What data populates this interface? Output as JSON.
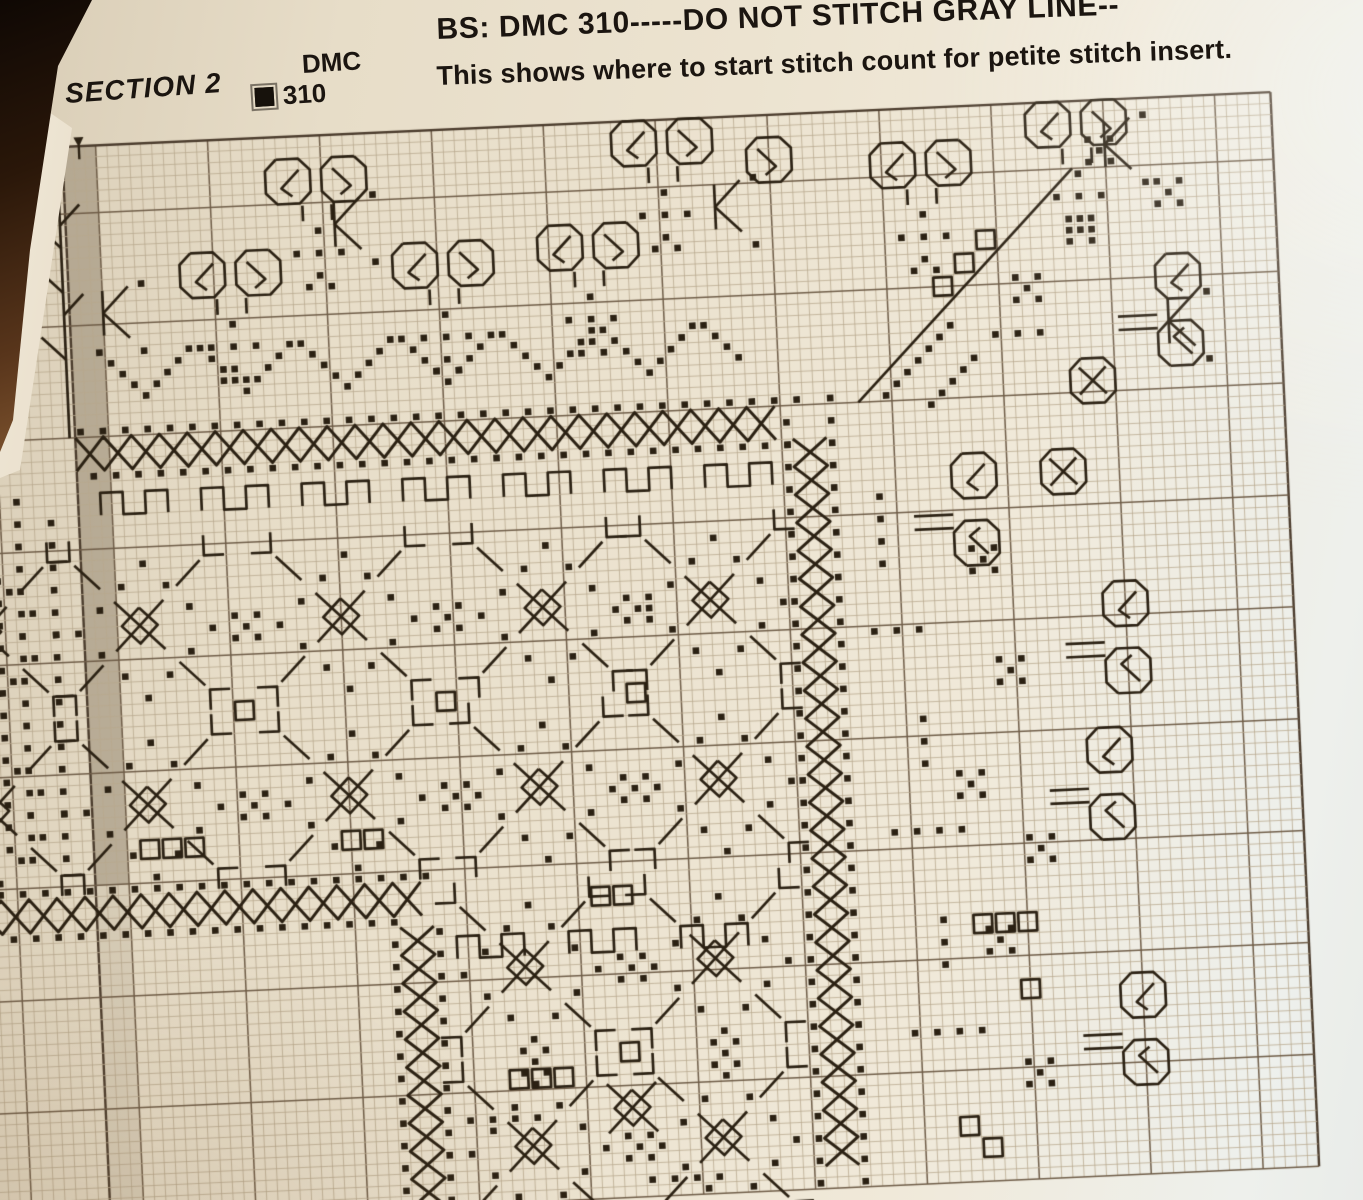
{
  "page": {
    "section_label": "SECTION 2",
    "legend": {
      "header": "DMC",
      "entries": [
        {
          "symbol": "filled-square",
          "code": "310"
        }
      ]
    },
    "note_line_1": "BS: DMC 310-----DO NOT STITCH GRAY LINE--",
    "note_line_2": "This shows where to start stitch count for petite stitch insert."
  },
  "colors": {
    "paper": "#ece3d0",
    "photo_background": "#20130b",
    "stitch": "#2b2113",
    "grid_line": "#b7a78d",
    "grid_bold": "#6e5c47",
    "grid_edge": "#4a3b2c",
    "gray_overlap_column": "#8d806a",
    "text": "#1b1510"
  },
  "chart_data": {
    "type": "cross-stitch-pattern-grid",
    "description": "Corner section of a blackwork-style cross stitch border chart in DMC 310; dotted/lattice frame bands, scroll lace edging, gray overlap column at left with start-arrow marker.",
    "grid": {
      "cell": 11.2,
      "col_min": -3,
      "col_max": 116,
      "row_max": 96,
      "left_edge_col": 8,
      "origin_x": 62,
      "origin_y": 147,
      "rotation_deg": -2.6,
      "bold_every": 10,
      "gray_column": {
        "col": 8,
        "width": 3,
        "row_fade": 66
      },
      "colors": {
        "line": "#b7a78d",
        "bold": "#6e5c47",
        "edge": "#4a3b2c",
        "stitch": "#2b2113",
        "gray": "#8d806a"
      }
    },
    "motifs": [
      {
        "t": "dotrun",
        "c": 8,
        "r": 25,
        "n": 33,
        "dx": 2,
        "dy": 0
      },
      {
        "t": "dotrun",
        "c": 9,
        "r": 29,
        "n": 32,
        "dx": 2,
        "dy": 0
      },
      {
        "t": "latticeH",
        "c": 8,
        "r": 26,
        "n": 64
      },
      {
        "t": "dotrun",
        "c": 71,
        "r": 27,
        "n": 35,
        "dx": 0,
        "dy": 2
      },
      {
        "t": "dotrun",
        "c": 75,
        "r": 25,
        "n": 36,
        "dx": 0,
        "dy": 2
      },
      {
        "t": "latticeV",
        "c": 72,
        "r": 29,
        "n": 66
      },
      {
        "t": "dotrun",
        "c": -3,
        "r": 66,
        "n": 21,
        "dx": 2,
        "dy": 0
      },
      {
        "t": "dotrun",
        "c": -2,
        "r": 70,
        "n": 19,
        "dx": 2,
        "dy": 0
      },
      {
        "t": "latticeH",
        "c": -3,
        "r": 67,
        "n": 41
      },
      {
        "t": "dotrun",
        "c": 34,
        "r": 72,
        "n": 12,
        "dx": 0,
        "dy": 2
      },
      {
        "t": "dotrun",
        "c": 38,
        "r": 71,
        "n": 13,
        "dx": 0,
        "dy": 2
      },
      {
        "t": "latticeV",
        "c": 35,
        "r": 71,
        "n": 25
      },
      {
        "t": "scrollpair",
        "c": 26,
        "r": 2
      },
      {
        "t": "scrollpair",
        "c": 57,
        "r": 0
      },
      {
        "t": "scroll",
        "c": 69,
        "r": 2,
        "fx": true
      },
      {
        "t": "scrollpair",
        "c": 94,
        "r": 0
      },
      {
        "t": "scrollpair",
        "c": 80,
        "r": 3
      },
      {
        "t": "scrollpair",
        "c": 18,
        "r": 10
      },
      {
        "t": "scrollpair",
        "c": 37,
        "r": 10
      },
      {
        "t": "scrollpair",
        "c": 50,
        "r": 9
      },
      {
        "t": "tree",
        "c": 30,
        "r": 8
      },
      {
        "t": "tree",
        "c": 61,
        "r": 6
      },
      {
        "t": "tree",
        "c": 22,
        "r": 16
      },
      {
        "t": "tree",
        "c": 41,
        "r": 16
      },
      {
        "t": "tree",
        "c": 54,
        "r": 15
      },
      {
        "t": "tree",
        "c": 84,
        "r": 9
      },
      {
        "t": "tree",
        "c": 98,
        "r": 6
      },
      {
        "t": "arrow",
        "c": 32,
        "r": 6
      },
      {
        "t": "arrow",
        "c": 66,
        "r": 6
      },
      {
        "t": "arrow",
        "c": 101,
        "r": 2
      },
      {
        "t": "arrow",
        "c": 106,
        "r": 18
      },
      {
        "t": "arrow",
        "c": 11,
        "r": 13
      },
      {
        "t": "dotrun",
        "c": 10,
        "r": 18,
        "n": 5,
        "dx": 1,
        "dy": 1
      },
      {
        "t": "dotrun",
        "c": 15,
        "r": 21,
        "n": 4,
        "dx": 1,
        "dy": -1
      },
      {
        "t": "dotrun",
        "c": 19,
        "r": 18,
        "n": 5,
        "dx": 1,
        "dy": 1
      },
      {
        "t": "dotrun",
        "c": 24,
        "r": 21,
        "n": 4,
        "dx": 1,
        "dy": -1
      },
      {
        "t": "dotrun",
        "c": 28,
        "r": 18,
        "n": 5,
        "dx": 1,
        "dy": 1
      },
      {
        "t": "dotrun",
        "c": 33,
        "r": 21,
        "n": 4,
        "dx": 1,
        "dy": -1
      },
      {
        "t": "dotrun",
        "c": 37,
        "r": 18,
        "n": 5,
        "dx": 1,
        "dy": 1
      },
      {
        "t": "dotrun",
        "c": 42,
        "r": 21,
        "n": 4,
        "dx": 1,
        "dy": -1
      },
      {
        "t": "dotrun",
        "c": 46,
        "r": 18,
        "n": 5,
        "dx": 1,
        "dy": 1
      },
      {
        "t": "dotrun",
        "c": 51,
        "r": 21,
        "n": 4,
        "dx": 1,
        "dy": -1
      },
      {
        "t": "dotrun",
        "c": 55,
        "r": 18,
        "n": 5,
        "dx": 1,
        "dy": 1
      },
      {
        "t": "dotrun",
        "c": 60,
        "r": 21,
        "n": 4,
        "dx": 1,
        "dy": -1
      },
      {
        "t": "dotrun",
        "c": 64,
        "r": 18,
        "n": 4,
        "dx": 1,
        "dy": 1
      },
      {
        "t": "line",
        "pts": [
          [
            78,
            26
          ],
          [
            98,
            6
          ]
        ]
      },
      {
        "t": "boxrun",
        "c": 85,
        "r": 15,
        "n": 3,
        "dx": 2,
        "dy": -2
      },
      {
        "t": "dotrun",
        "c": 80,
        "r": 25,
        "n": 7,
        "dx": 1,
        "dy": -1
      },
      {
        "t": "dotrun",
        "c": 84,
        "r": 26,
        "n": 5,
        "dx": 1,
        "dy": -1
      },
      {
        "t": "quint",
        "c": 93,
        "r": 16
      },
      {
        "t": "quint",
        "c": 98,
        "r": 11
      },
      {
        "t": "dotrun",
        "c": 90,
        "r": 20,
        "n": 3,
        "dx": 2,
        "dy": 0
      },
      {
        "t": "quint",
        "c": 100,
        "r": 4
      },
      {
        "t": "quint",
        "c": 106,
        "r": 8
      },
      {
        "t": "scrollpairV",
        "c": 105,
        "r": 14
      },
      {
        "t": "octx",
        "c": 97,
        "r": 23
      },
      {
        "t": "octx",
        "c": 94,
        "r": 31
      },
      {
        "t": "scrollpairV",
        "c": 86,
        "r": 31
      },
      {
        "t": "scrollpairV",
        "c": 99,
        "r": 43
      },
      {
        "t": "scrollpairV",
        "c": 97,
        "r": 56
      },
      {
        "t": "scrollpairV",
        "c": 99,
        "r": 78
      },
      {
        "t": "quint",
        "c": 88,
        "r": 40
      },
      {
        "t": "quint",
        "c": 90,
        "r": 50
      },
      {
        "t": "quint",
        "c": 86,
        "r": 60
      },
      {
        "t": "quint",
        "c": 92,
        "r": 66
      },
      {
        "t": "quint",
        "c": 88,
        "r": 74
      },
      {
        "t": "quint",
        "c": 91,
        "r": 86
      },
      {
        "t": "dotrun",
        "c": 79,
        "r": 34,
        "n": 4,
        "dx": 0,
        "dy": 2
      },
      {
        "t": "dotrun",
        "c": 78,
        "r": 46,
        "n": 3,
        "dx": 2,
        "dy": 0
      },
      {
        "t": "dotrun",
        "c": 82,
        "r": 54,
        "n": 3,
        "dx": 0,
        "dy": 2
      },
      {
        "t": "dotrun",
        "c": 79,
        "r": 64,
        "n": 4,
        "dx": 2,
        "dy": 0
      },
      {
        "t": "dotrun",
        "c": 83,
        "r": 72,
        "n": 3,
        "dx": 0,
        "dy": 2
      },
      {
        "t": "dotrun",
        "c": 80,
        "r": 82,
        "n": 4,
        "dx": 2,
        "dy": 0
      },
      {
        "t": "boxrun",
        "c": 86,
        "r": 72,
        "n": 3,
        "dx": 2,
        "dy": 0
      },
      {
        "t": "sqout",
        "c": 90,
        "r": 78,
        "w": 2,
        "h": 2
      },
      {
        "t": "boxrun",
        "c": 84,
        "r": 90,
        "n": 2,
        "dx": 2,
        "dy": 2
      },
      {
        "t": "tile",
        "c": 13,
        "r": 43
      },
      {
        "t": "tile",
        "c": 31,
        "r": 43
      },
      {
        "t": "tile",
        "c": 49,
        "r": 43
      },
      {
        "t": "tile",
        "c": 64,
        "r": 43
      },
      {
        "t": "tile",
        "c": 13,
        "r": 59
      },
      {
        "t": "tile",
        "c": 31,
        "r": 59
      },
      {
        "t": "tile",
        "c": 48,
        "r": 59
      },
      {
        "t": "tile",
        "c": 64,
        "r": 59
      },
      {
        "t": "tile",
        "c": 46,
        "r": 75
      },
      {
        "t": "tile",
        "c": 63,
        "r": 75
      },
      {
        "t": "tile",
        "c": 46,
        "r": 91
      },
      {
        "t": "tile",
        "c": 63,
        "r": 91
      },
      {
        "t": "tile",
        "c": -1,
        "r": 43
      },
      {
        "t": "tile",
        "c": -1,
        "r": 59
      },
      {
        "t": "quint",
        "c": 22,
        "r": 43
      },
      {
        "t": "quint",
        "c": 40,
        "r": 43
      },
      {
        "t": "quint",
        "c": 57,
        "r": 43
      },
      {
        "t": "quint",
        "c": 22,
        "r": 59
      },
      {
        "t": "quint",
        "c": 40,
        "r": 59
      },
      {
        "t": "quint",
        "c": 56,
        "r": 59
      },
      {
        "t": "sqout",
        "c": 21,
        "r": 50,
        "w": 2,
        "h": 2
      },
      {
        "t": "sqout",
        "c": 39,
        "r": 50,
        "w": 2,
        "h": 2
      },
      {
        "t": "sqout",
        "c": 56,
        "r": 50,
        "w": 2,
        "h": 2
      },
      {
        "t": "quint",
        "c": 55,
        "r": 75
      },
      {
        "t": "quint",
        "c": 55,
        "r": 91
      },
      {
        "t": "quint",
        "c": 46,
        "r": 83
      },
      {
        "t": "quint",
        "c": 63,
        "r": 83
      },
      {
        "t": "sqout",
        "c": 54,
        "r": 82,
        "w": 2,
        "h": 2
      },
      {
        "t": "step",
        "c": 10,
        "r": 31
      },
      {
        "t": "step",
        "c": 19,
        "r": 31
      },
      {
        "t": "step",
        "c": 28,
        "r": 31
      },
      {
        "t": "step",
        "c": 37,
        "r": 31
      },
      {
        "t": "step",
        "c": 46,
        "r": 31
      },
      {
        "t": "step",
        "c": 55,
        "r": 31
      },
      {
        "t": "step",
        "c": 64,
        "r": 31
      },
      {
        "t": "step",
        "c": 40,
        "r": 72
      },
      {
        "t": "step",
        "c": 50,
        "r": 72
      },
      {
        "t": "step",
        "c": 60,
        "r": 72
      },
      {
        "t": "boxrun",
        "c": 12,
        "r": 62,
        "n": 3,
        "dx": 2,
        "dy": 0
      },
      {
        "t": "boxrun",
        "c": 30,
        "r": 62,
        "n": 2,
        "dx": 2,
        "dy": 0
      },
      {
        "t": "boxrun",
        "c": 44,
        "r": 84,
        "n": 3,
        "dx": 2,
        "dy": 0
      },
      {
        "t": "boxrun",
        "c": 52,
        "r": 68,
        "n": 2,
        "dx": 2,
        "dy": 0
      },
      {
        "t": "dotrun",
        "c": 2,
        "r": 31,
        "n": 17,
        "dx": 0,
        "dy": 2
      },
      {
        "t": "dotrun",
        "c": 5,
        "r": 33,
        "n": 16,
        "dx": 0,
        "dy": 2
      },
      {
        "t": "dotrun",
        "c": 0,
        "r": 36,
        "n": 14,
        "dx": 0,
        "dy": 2
      },
      {
        "t": "line",
        "pts": [
          [
            7.5,
            0.3
          ],
          [
            7.5,
            26
          ]
        ]
      },
      {
        "t": "line",
        "pts": [
          [
            7.5,
            5
          ],
          [
            5.4,
            2.9
          ]
        ]
      },
      {
        "t": "line",
        "pts": [
          [
            7.5,
            9
          ],
          [
            5.4,
            6.9
          ]
        ]
      },
      {
        "t": "line",
        "pts": [
          [
            7.5,
            13
          ],
          [
            5.4,
            10.9
          ]
        ]
      },
      {
        "t": "line",
        "pts": [
          [
            7.5,
            19
          ],
          [
            5.4,
            16.9
          ]
        ]
      },
      {
        "t": "line",
        "pts": [
          [
            7.5,
            7
          ],
          [
            9.3,
            5.2
          ]
        ]
      },
      {
        "t": "line",
        "pts": [
          [
            7.5,
            15
          ],
          [
            9.3,
            13.2
          ]
        ]
      },
      {
        "t": "marker",
        "c": 9.5,
        "r": 0
      },
      {
        "t": "dotrun",
        "c": 40,
        "r": 88,
        "n": 4,
        "dx": 2,
        "dy": 0
      },
      {
        "t": "dotrun",
        "c": 56,
        "r": 94,
        "n": 4,
        "dx": 2,
        "dy": 0
      },
      {
        "t": "xflake",
        "c": 55,
        "r": 88
      }
    ]
  }
}
